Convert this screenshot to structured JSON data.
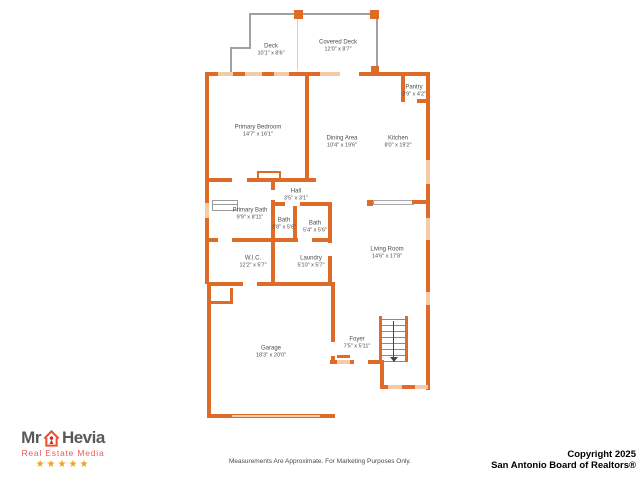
{
  "plan": {
    "rooms": {
      "deck": {
        "name": "Deck",
        "dims": "10'1\" x 8'6\""
      },
      "covered_deck": {
        "name": "Covered Deck",
        "dims": "12'0\" x 8'7\""
      },
      "pantry": {
        "name": "Pantry",
        "dims": "3'9\" x 4'2\""
      },
      "primary_bedroom": {
        "name": "Primary Bedroom",
        "dims": "14'7\" x 16'1\""
      },
      "dining_area": {
        "name": "Dining Area",
        "dims": "10'4\" x 19'6\""
      },
      "kitchen": {
        "name": "Kitchen",
        "dims": "8'0\" x 19'2\""
      },
      "hall": {
        "name": "Hall",
        "dims": "3'5\" x 3'1\""
      },
      "primary_bath": {
        "name": "Primary Bath",
        "dims": "9'9\" x 8'11\""
      },
      "bath_wc": {
        "name": "Bath",
        "dims": "3'8\" x 5'6\""
      },
      "bath": {
        "name": "Bath",
        "dims": "5'4\" x 5'6\""
      },
      "wic": {
        "name": "W.I.C.",
        "dims": "12'2\" x 5'7\""
      },
      "laundry": {
        "name": "Laundry",
        "dims": "5'10\" x 5'7\""
      },
      "living_room": {
        "name": "Living Room",
        "dims": "14'6\" x 17'8\""
      },
      "foyer": {
        "name": "Foyer",
        "dims": "7'5\" x 5'11\""
      },
      "garage": {
        "name": "Garage",
        "dims": "18'3\" x 20'0\""
      }
    },
    "colors": {
      "wall": "#df6b28",
      "window": "#f5cba6",
      "deck_outline": "#a0a0a0",
      "label_text": "#4d4d4d"
    }
  },
  "branding": {
    "name_part1": "Mr",
    "name_part2": "Hevia",
    "tagline": "Real Estate Media",
    "stars": "★★★★★",
    "house_icon": "house-icon"
  },
  "footer": {
    "disclaimer": "Measurements Are Approximate. For Marketing Purposes Only.",
    "copyright_line1": "Copyright 2025",
    "copyright_line2": "San Antonio Board of Realtors®"
  }
}
